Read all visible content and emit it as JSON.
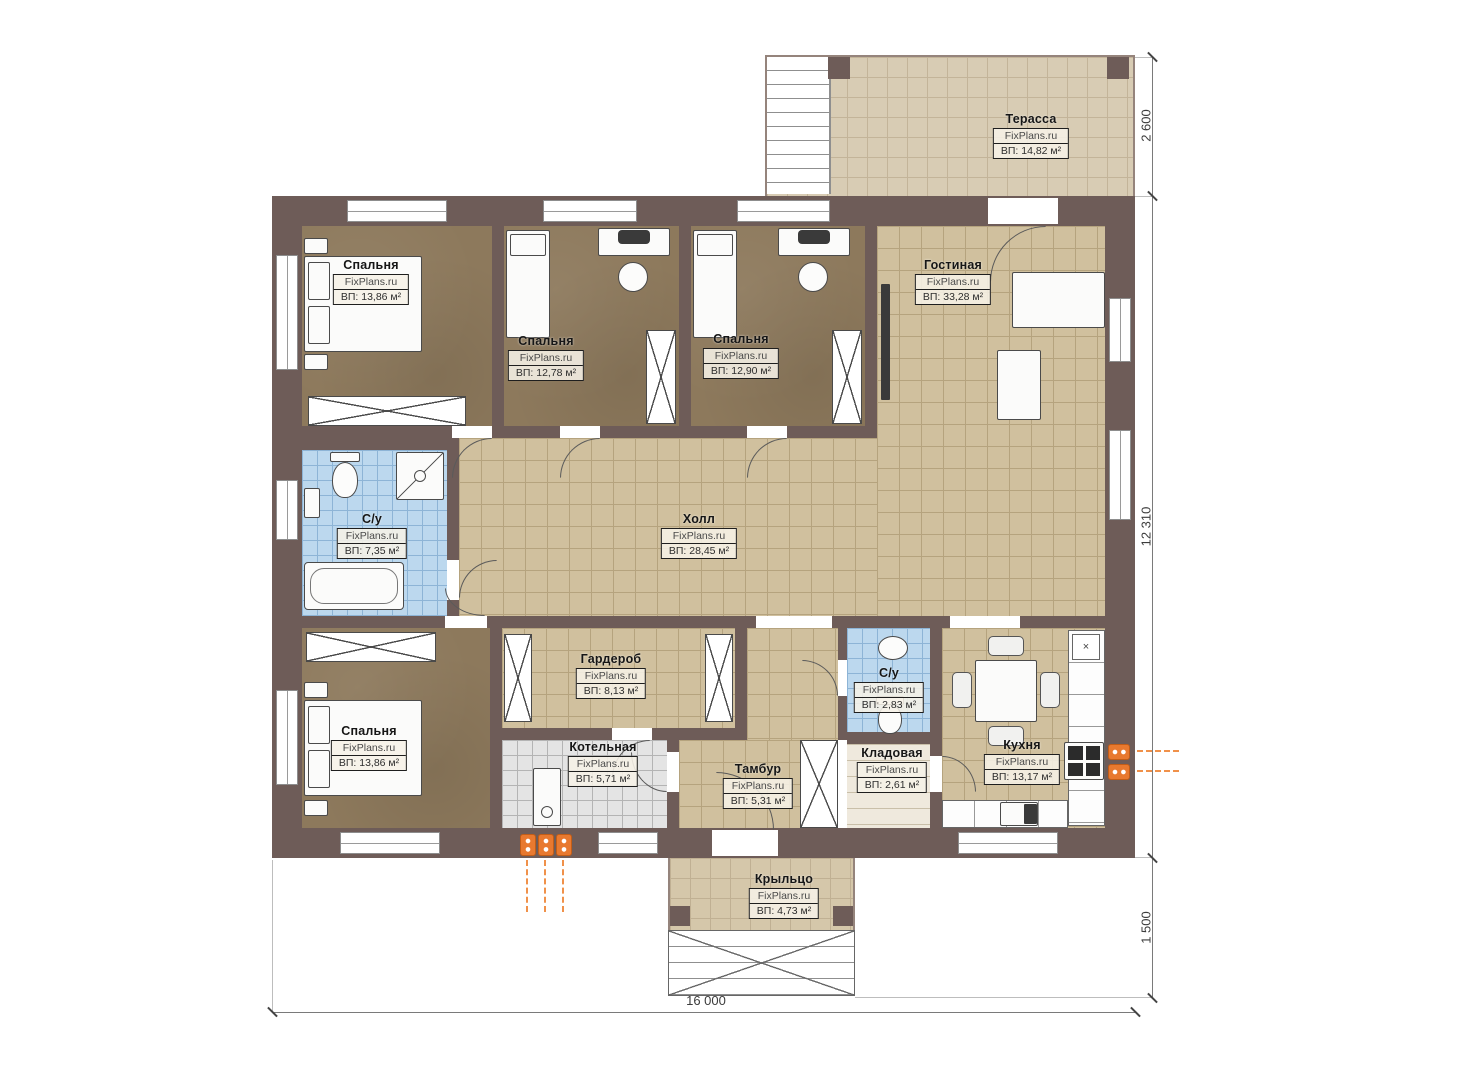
{
  "rooms": [
    {
      "name": "Терасса",
      "watermark": "FixPlans.ru",
      "area": "ВП: 14,82 м²"
    },
    {
      "name": "Спальня",
      "watermark": "FixPlans.ru",
      "area": "ВП: 13,86 м²"
    },
    {
      "name": "Спальня",
      "watermark": "FixPlans.ru",
      "area": "ВП: 12,78 м²"
    },
    {
      "name": "Спальня",
      "watermark": "FixPlans.ru",
      "area": "ВП: 12,90 м²"
    },
    {
      "name": "Гостиная",
      "watermark": "FixPlans.ru",
      "area": "ВП: 33,28 м²"
    },
    {
      "name": "С/у",
      "watermark": "FixPlans.ru",
      "area": "ВП: 7,35 м²"
    },
    {
      "name": "Холл",
      "watermark": "FixPlans.ru",
      "area": "ВП: 28,45 м²"
    },
    {
      "name": "Гардероб",
      "watermark": "FixPlans.ru",
      "area": "ВП: 8,13 м²"
    },
    {
      "name": "Спальня",
      "watermark": "FixPlans.ru",
      "area": "ВП: 13,86 м²"
    },
    {
      "name": "Котельная",
      "watermark": "FixPlans.ru",
      "area": "ВП: 5,71 м²"
    },
    {
      "name": "С/у",
      "watermark": "FixPlans.ru",
      "area": "ВП: 2,83 м²"
    },
    {
      "name": "Тамбур",
      "watermark": "FixPlans.ru",
      "area": "ВП: 5,31 м²"
    },
    {
      "name": "Кладовая",
      "watermark": "FixPlans.ru",
      "area": "ВП: 2,61 м²"
    },
    {
      "name": "Кухня",
      "watermark": "FixPlans.ru",
      "area": "ВП: 13,17 м²"
    },
    {
      "name": "Крыльцо",
      "watermark": "FixPlans.ru",
      "area": "ВП: 4,73 м²"
    }
  ],
  "dimensions": {
    "terrace_depth": "2 600",
    "house_depth": "12 310",
    "porch_depth": "1 500",
    "house_width": "16 000"
  },
  "symbols": {
    "hood": "×"
  },
  "colors": {
    "wall": "#6e5c58",
    "tile_tan": "#d0c09e",
    "tile_blue": "#bcd8ee",
    "tile_gray": "#e4e4e4",
    "floor_brown": "#8d795c",
    "terrace": "#d8ccb4",
    "accent_orange": "#e8792f"
  }
}
